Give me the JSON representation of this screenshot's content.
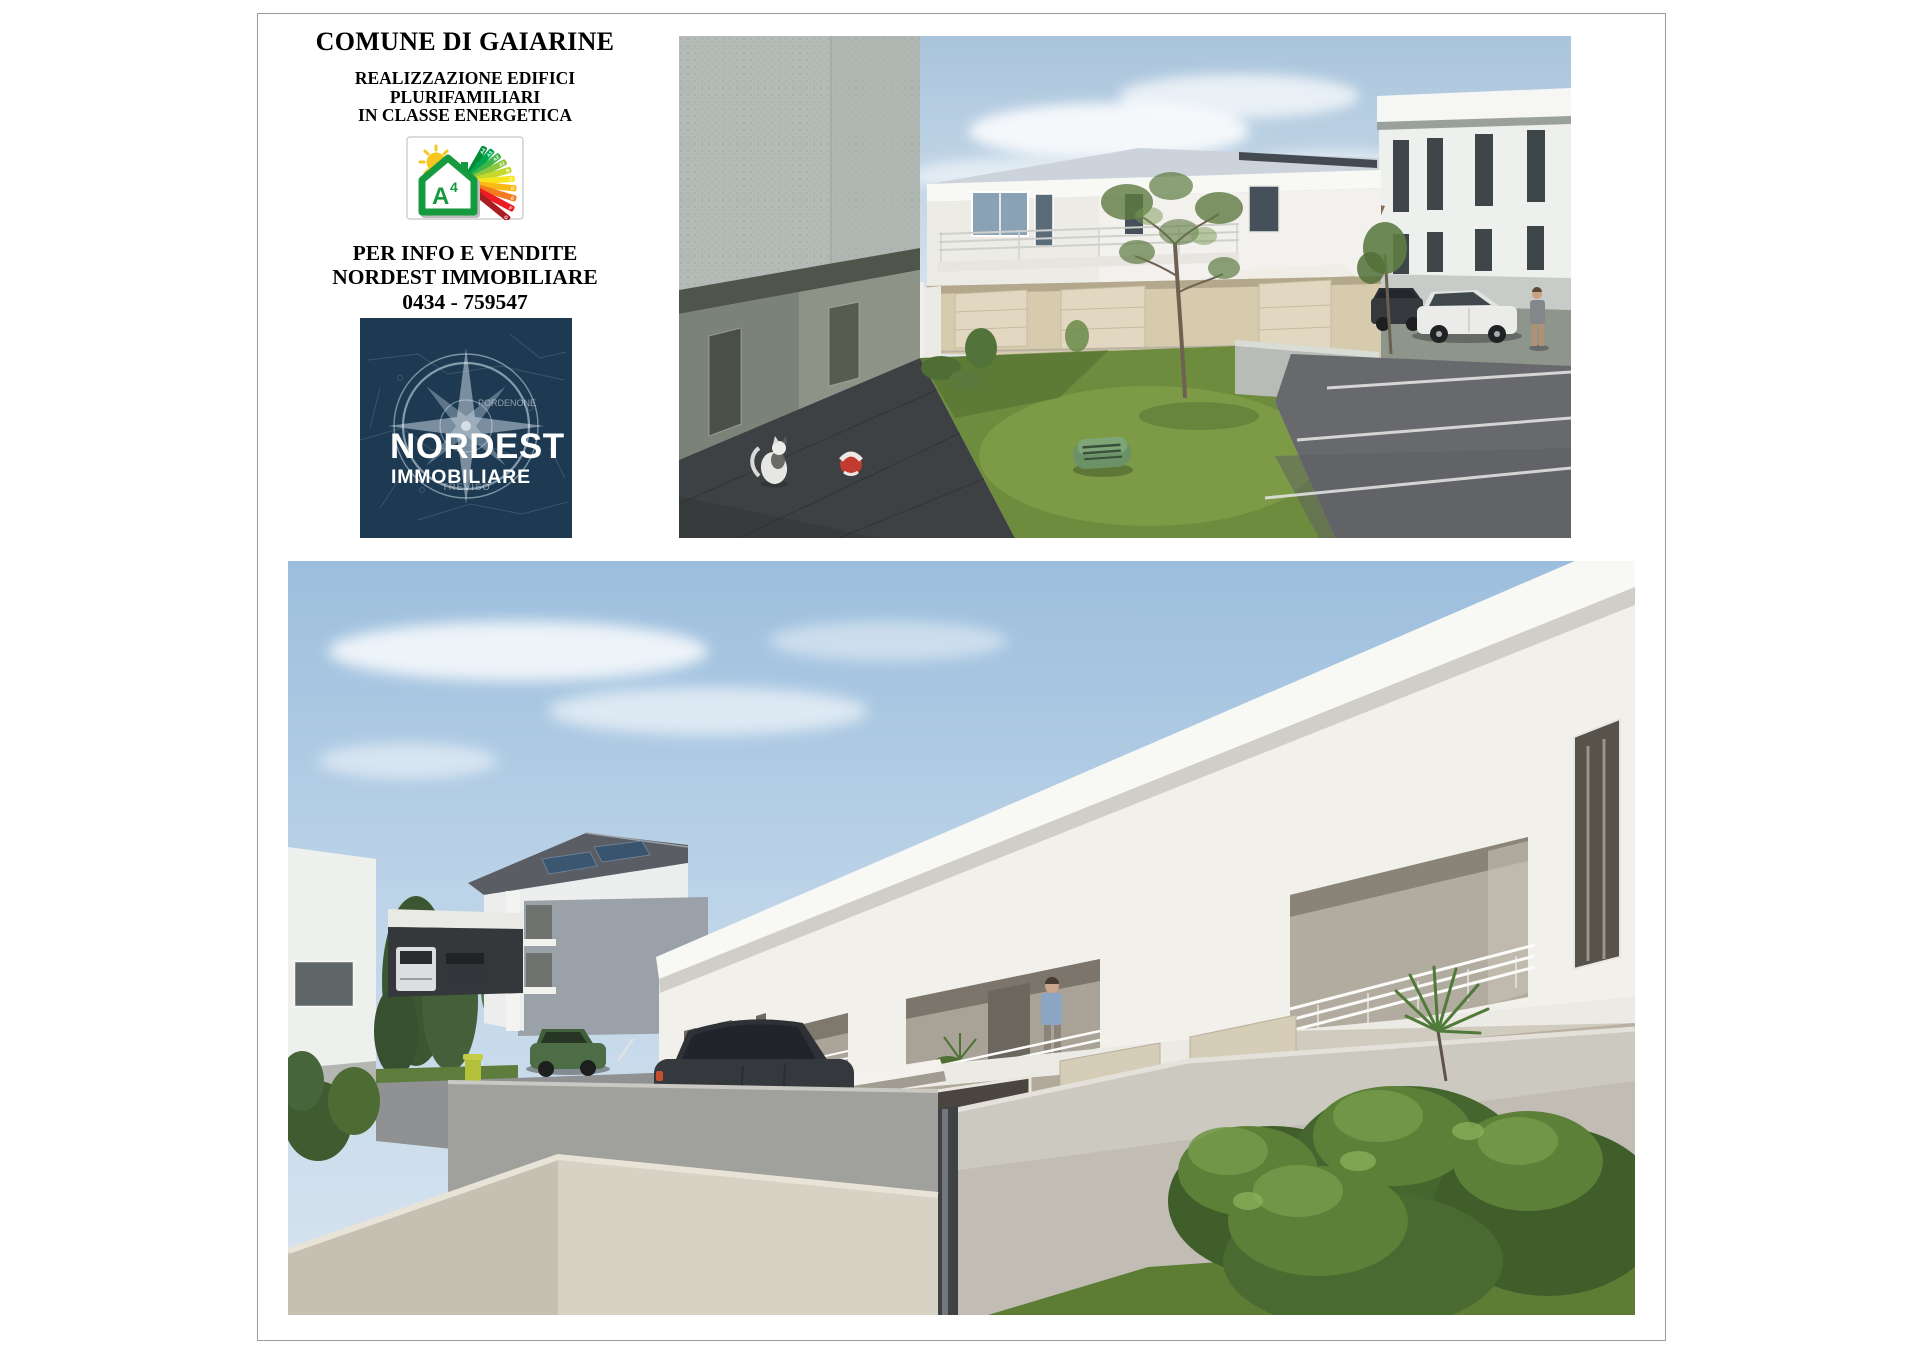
{
  "page": {
    "background": "#ffffff",
    "flyer_border_color": "#9b9b9b"
  },
  "header": {
    "title": "COMUNE DI GAIARINE",
    "subtitle_lines": [
      "REALIZZAZIONE EDIFICI",
      "PLURIFAMILIARI",
      "IN CLASSE ENERGETICA"
    ],
    "info_lines": [
      "PER INFO E VENDITE",
      "NORDEST IMMOBILIARE",
      "0434 - 759547"
    ]
  },
  "energy_badge": {
    "class_letter": "A",
    "class_exponent": "4",
    "house_color": "#169a3f",
    "sun_color": "#f7c71f",
    "bars": [
      {
        "label": "A4",
        "color": "#008d36"
      },
      {
        "label": "A3",
        "color": "#00a650"
      },
      {
        "label": "A2",
        "color": "#3cb54a"
      },
      {
        "label": "A1",
        "color": "#8dc63f"
      },
      {
        "label": "B",
        "color": "#c5d92d"
      },
      {
        "label": "C",
        "color": "#f5e61e"
      },
      {
        "label": "D",
        "color": "#fdb913"
      },
      {
        "label": "E",
        "color": "#f47c20"
      },
      {
        "label": "F",
        "color": "#ed1c24"
      },
      {
        "label": "G",
        "color": "#a81d22"
      }
    ]
  },
  "agency_logo": {
    "name": "NORDEST",
    "subname": "IMMOBILIARE",
    "background": "#1d3a52",
    "map_labels": {
      "east": "PORDENONE",
      "south": "TREVISO"
    }
  },
  "photos": {
    "top": {
      "description": "Rendering esterno: giardino con prato, albero, robot tagliaerba, gatto e parcheggio con auto"
    },
    "bottom": {
      "description": "Rendering esterno: angolo strada con balconi, garage, auto parcheggiate e siepi"
    }
  }
}
